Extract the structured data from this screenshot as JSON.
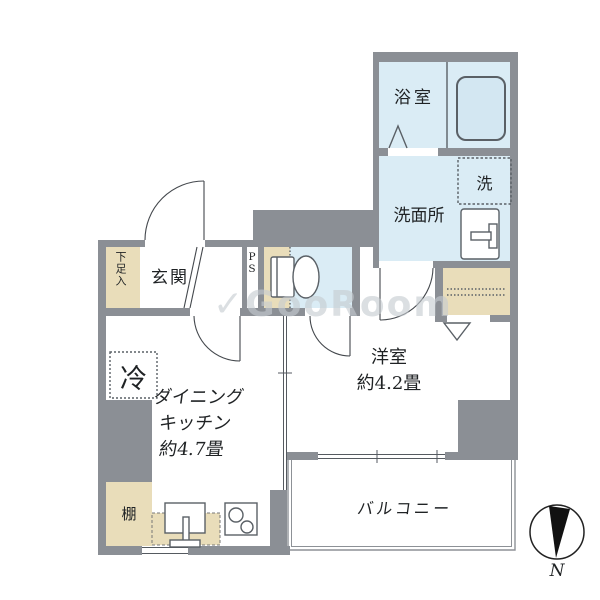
{
  "rooms": {
    "bath": "浴室",
    "washer": "洗",
    "washroom": "洗面所",
    "entrance": "玄関",
    "shoe_storage": "下足入",
    "pipe_space": "PS",
    "refrigerator": "冷",
    "dining_kitchen": {
      "name_line1": "ダイニング",
      "name_line2": "キッチン",
      "size": "約4.7畳"
    },
    "western_room": {
      "name": "洋室",
      "size": "約4.2畳"
    },
    "balcony": "バルコニー",
    "shelf": "棚"
  },
  "compass": {
    "north": "N"
  },
  "watermark": {
    "logo": "✓",
    "text": "GooRoom"
  },
  "colors": {
    "wall": "#8b8f95",
    "water_area": "#daecf5",
    "wood_area": "#e9ddba",
    "fixture_line": "#5a6066",
    "ink": "#222222"
  }
}
